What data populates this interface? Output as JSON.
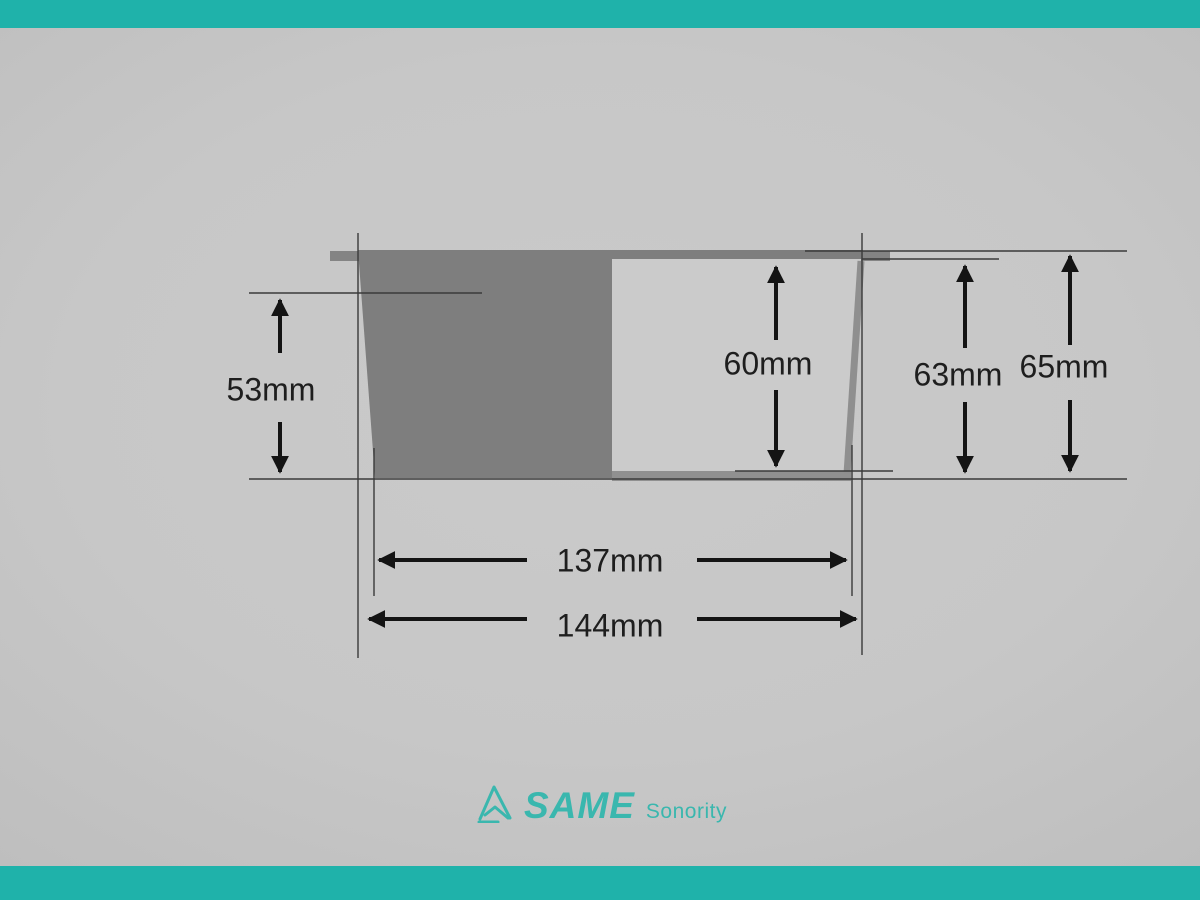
{
  "window": {
    "width": 1200,
    "height": 900
  },
  "theme": {
    "accent_teal": "#1fb2aa",
    "logo_teal": "#3ab7ae",
    "background_gray": "#c7c7c7",
    "body_gray": "#7e7e7e",
    "cavity_gray": "#cbcbcb",
    "edge_gray": "#909090",
    "line_color": "#3a3a3a",
    "arrow_color": "#141414",
    "label_color": "#1e1e1e"
  },
  "diagram": {
    "description": "cross-section dimension drawing of speaker basket",
    "dimensions": [
      {
        "id": "inner-depth-left",
        "label": "53mm"
      },
      {
        "id": "cavity-depth",
        "label": "60mm"
      },
      {
        "id": "mid-height",
        "label": "63mm"
      },
      {
        "id": "overall-height",
        "label": "65mm"
      },
      {
        "id": "inner-width",
        "label": "137mm"
      },
      {
        "id": "overall-width",
        "label": "144mm"
      }
    ]
  },
  "logo": {
    "brand": "SAME",
    "tagline": "Sonority"
  }
}
